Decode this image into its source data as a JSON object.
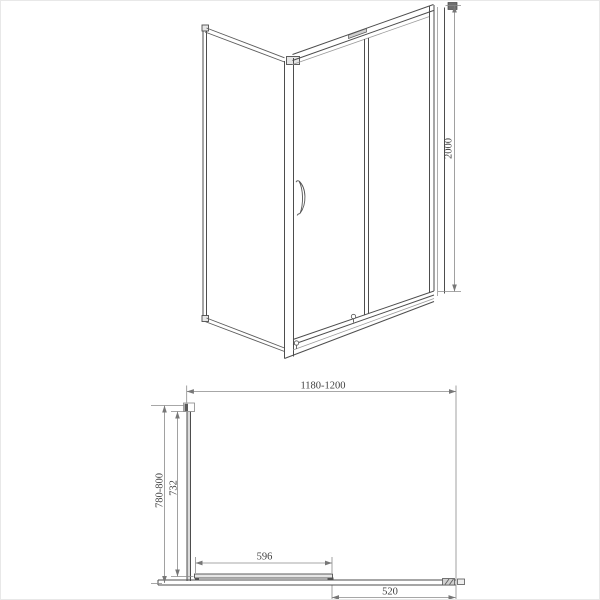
{
  "page": {
    "background": "#ffffff",
    "border": "#e8e8e8"
  },
  "drawing": {
    "views": {
      "perspective": {
        "dimensions": [
          {
            "id": "height",
            "label": "2000"
          }
        ]
      },
      "plan": {
        "dimensions": [
          {
            "id": "overall-width",
            "label": "1180-1200"
          },
          {
            "id": "overall-depth",
            "label": "780-800"
          },
          {
            "id": "side-glass-depth",
            "label": "732"
          },
          {
            "id": "door-panel-width",
            "label": "596"
          },
          {
            "id": "fixed-panel-width",
            "label": "520"
          }
        ]
      }
    },
    "colors": {
      "object_line": "#4d4d4d",
      "dim_line": "#8a8a8a",
      "text": "#3f3f3f"
    }
  }
}
